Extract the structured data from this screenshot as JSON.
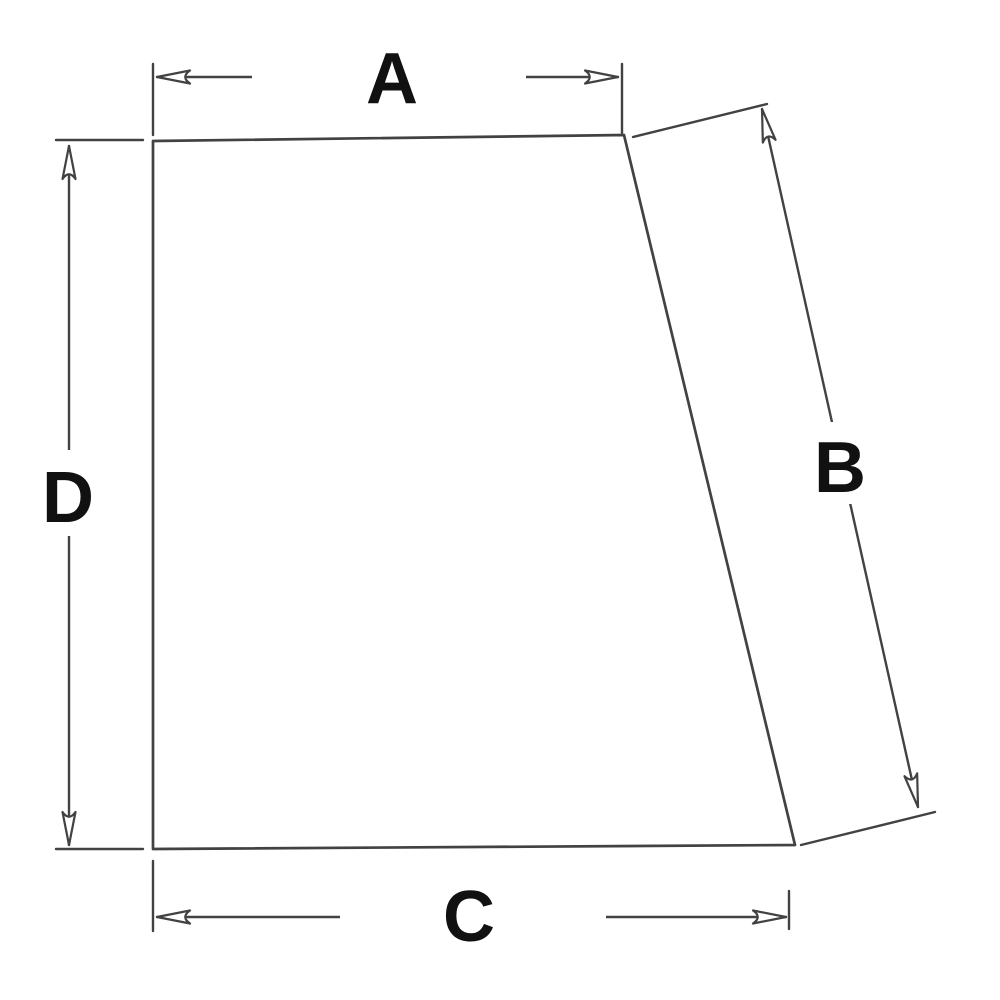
{
  "diagram": {
    "type": "technical-dimension-drawing",
    "subject": "quadrilateral-glass-panel-outline",
    "colors": {
      "background": "#ffffff",
      "line": "#424242",
      "label": "#111111"
    },
    "dimensions": [
      {
        "label": "A",
        "edge": "top-width"
      },
      {
        "label": "B",
        "edge": "right-slanted-edge-length"
      },
      {
        "label": "C",
        "edge": "bottom-width"
      },
      {
        "label": "D",
        "edge": "left-height"
      }
    ]
  }
}
